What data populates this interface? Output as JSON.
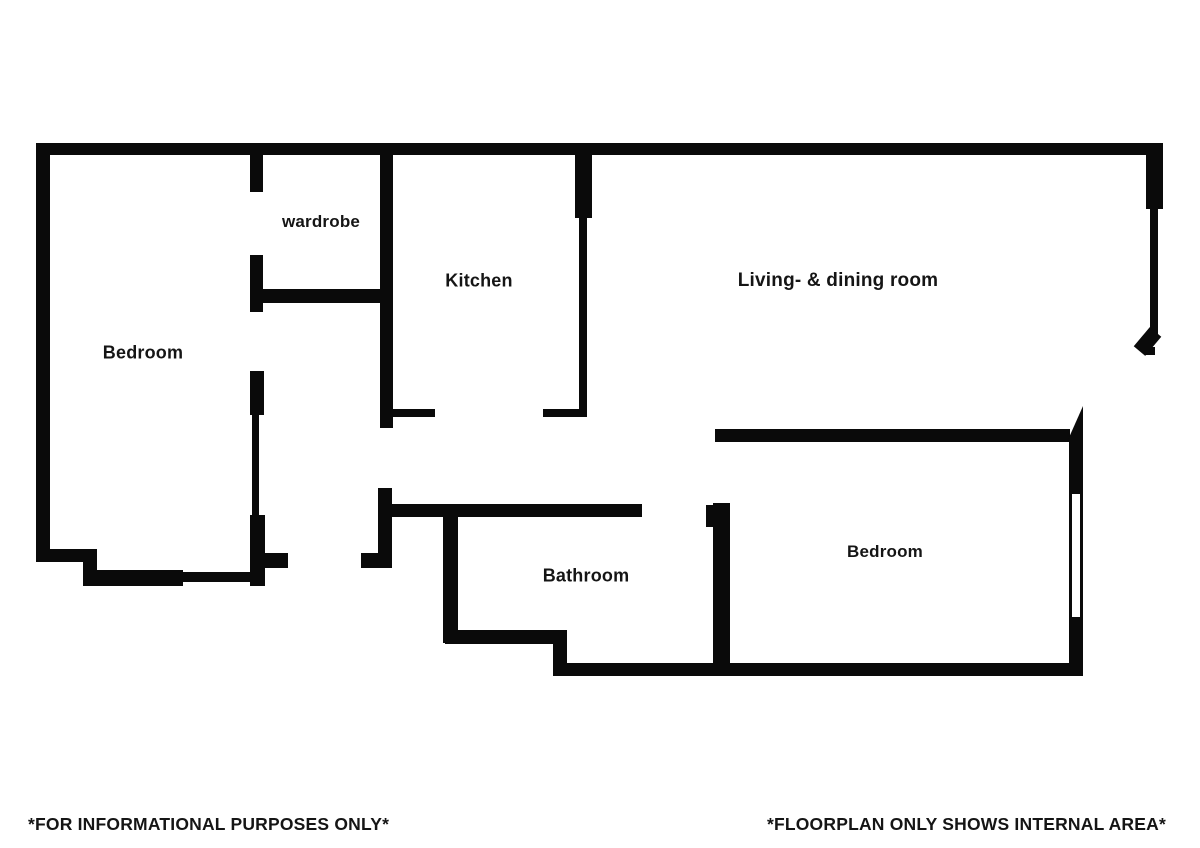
{
  "page": {
    "background": "#ffffff",
    "wall_color": "#0a0a0a",
    "text_color": "#151515"
  },
  "floorplan": {
    "walls": [
      [
        36,
        143,
        1127,
        12
      ],
      [
        36,
        143,
        14,
        419
      ],
      [
        1146,
        143,
        17,
        66
      ],
      [
        1150,
        209,
        8,
        125
      ],
      [
        1146,
        347,
        9,
        8
      ],
      [
        36,
        549,
        61,
        13
      ],
      [
        83,
        549,
        14,
        37
      ],
      [
        83,
        570,
        100,
        16
      ],
      [
        183,
        572,
        70,
        10
      ],
      [
        250,
        515,
        15,
        71
      ],
      [
        250,
        155,
        13,
        37
      ],
      [
        250,
        255,
        13,
        57
      ],
      [
        263,
        289,
        118,
        14
      ],
      [
        250,
        371,
        14,
        44
      ],
      [
        252,
        415,
        7,
        100
      ],
      [
        265,
        553,
        23,
        15
      ],
      [
        361,
        553,
        18,
        15
      ],
      [
        378,
        488,
        14,
        80
      ],
      [
        380,
        143,
        13,
        285
      ],
      [
        392,
        409,
        43,
        8
      ],
      [
        575,
        143,
        17,
        75
      ],
      [
        579,
        218,
        8,
        194
      ],
      [
        543,
        409,
        44,
        8
      ],
      [
        715,
        429,
        355,
        13
      ],
      [
        1069,
        442,
        14,
        52
      ],
      [
        1069,
        617,
        14,
        59
      ],
      [
        553,
        663,
        530,
        13
      ],
      [
        713,
        503,
        17,
        160
      ],
      [
        706,
        505,
        8,
        22
      ],
      [
        392,
        504,
        250,
        13
      ],
      [
        443,
        510,
        15,
        133
      ],
      [
        445,
        630,
        122,
        14
      ],
      [
        553,
        630,
        14,
        46
      ]
    ],
    "windows": [
      [
        1069,
        494,
        14,
        123
      ]
    ],
    "door_leaves": [
      {
        "x": 1140,
        "y": 329,
        "w": 15,
        "h": 25,
        "rot": 40
      },
      {
        "x": 1067,
        "y": 406,
        "w": 16,
        "h": 36,
        "shape": "triangle"
      }
    ],
    "rooms": [
      {
        "id": "bedroom-left",
        "label": "Bedroom",
        "x": 143,
        "y": 353,
        "size": 18
      },
      {
        "id": "wardrobe",
        "label": "wardrobe",
        "x": 321,
        "y": 222,
        "size": 17
      },
      {
        "id": "kitchen",
        "label": "Kitchen",
        "x": 479,
        "y": 281,
        "size": 18
      },
      {
        "id": "living-dining",
        "label": "Living- & dining room",
        "x": 838,
        "y": 281,
        "size": 19
      },
      {
        "id": "bathroom",
        "label": "Bathroom",
        "x": 586,
        "y": 576,
        "size": 18
      },
      {
        "id": "bedroom-right",
        "label": "Bedroom",
        "x": 885,
        "y": 552,
        "size": 17
      }
    ]
  },
  "footer": {
    "left": "*FOR INFORMATIONAL PURPOSES ONLY*",
    "right": "*FLOORPLAN ONLY SHOWS INTERNAL AREA*"
  }
}
